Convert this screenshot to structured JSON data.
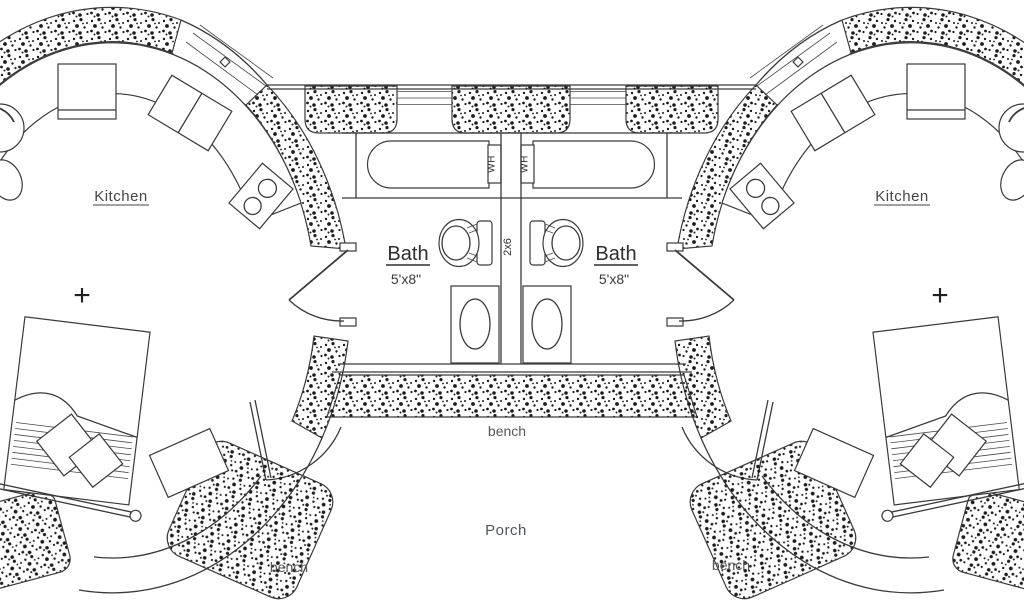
{
  "plan": {
    "rooms": {
      "kitchen_left": "Kitchen",
      "kitchen_right": "Kitchen",
      "bath_left": "Bath",
      "bath_left_size": "5'x8\"",
      "bath_right": "Bath",
      "bath_right_size": "5'x8\"",
      "porch": "Porch"
    },
    "fixtures": {
      "water_heater_left": "WH",
      "water_heater_right": "WH",
      "center_wall_stud": "2x6"
    },
    "benches": {
      "center": "bench",
      "left": "bench",
      "right": "bench"
    },
    "markers": {
      "left_center": "+",
      "right_center": "+"
    },
    "colors": {
      "ink": "#3a3a3a",
      "label": "#474747",
      "muted_label": "#585858",
      "background": "#ffffff"
    }
  }
}
